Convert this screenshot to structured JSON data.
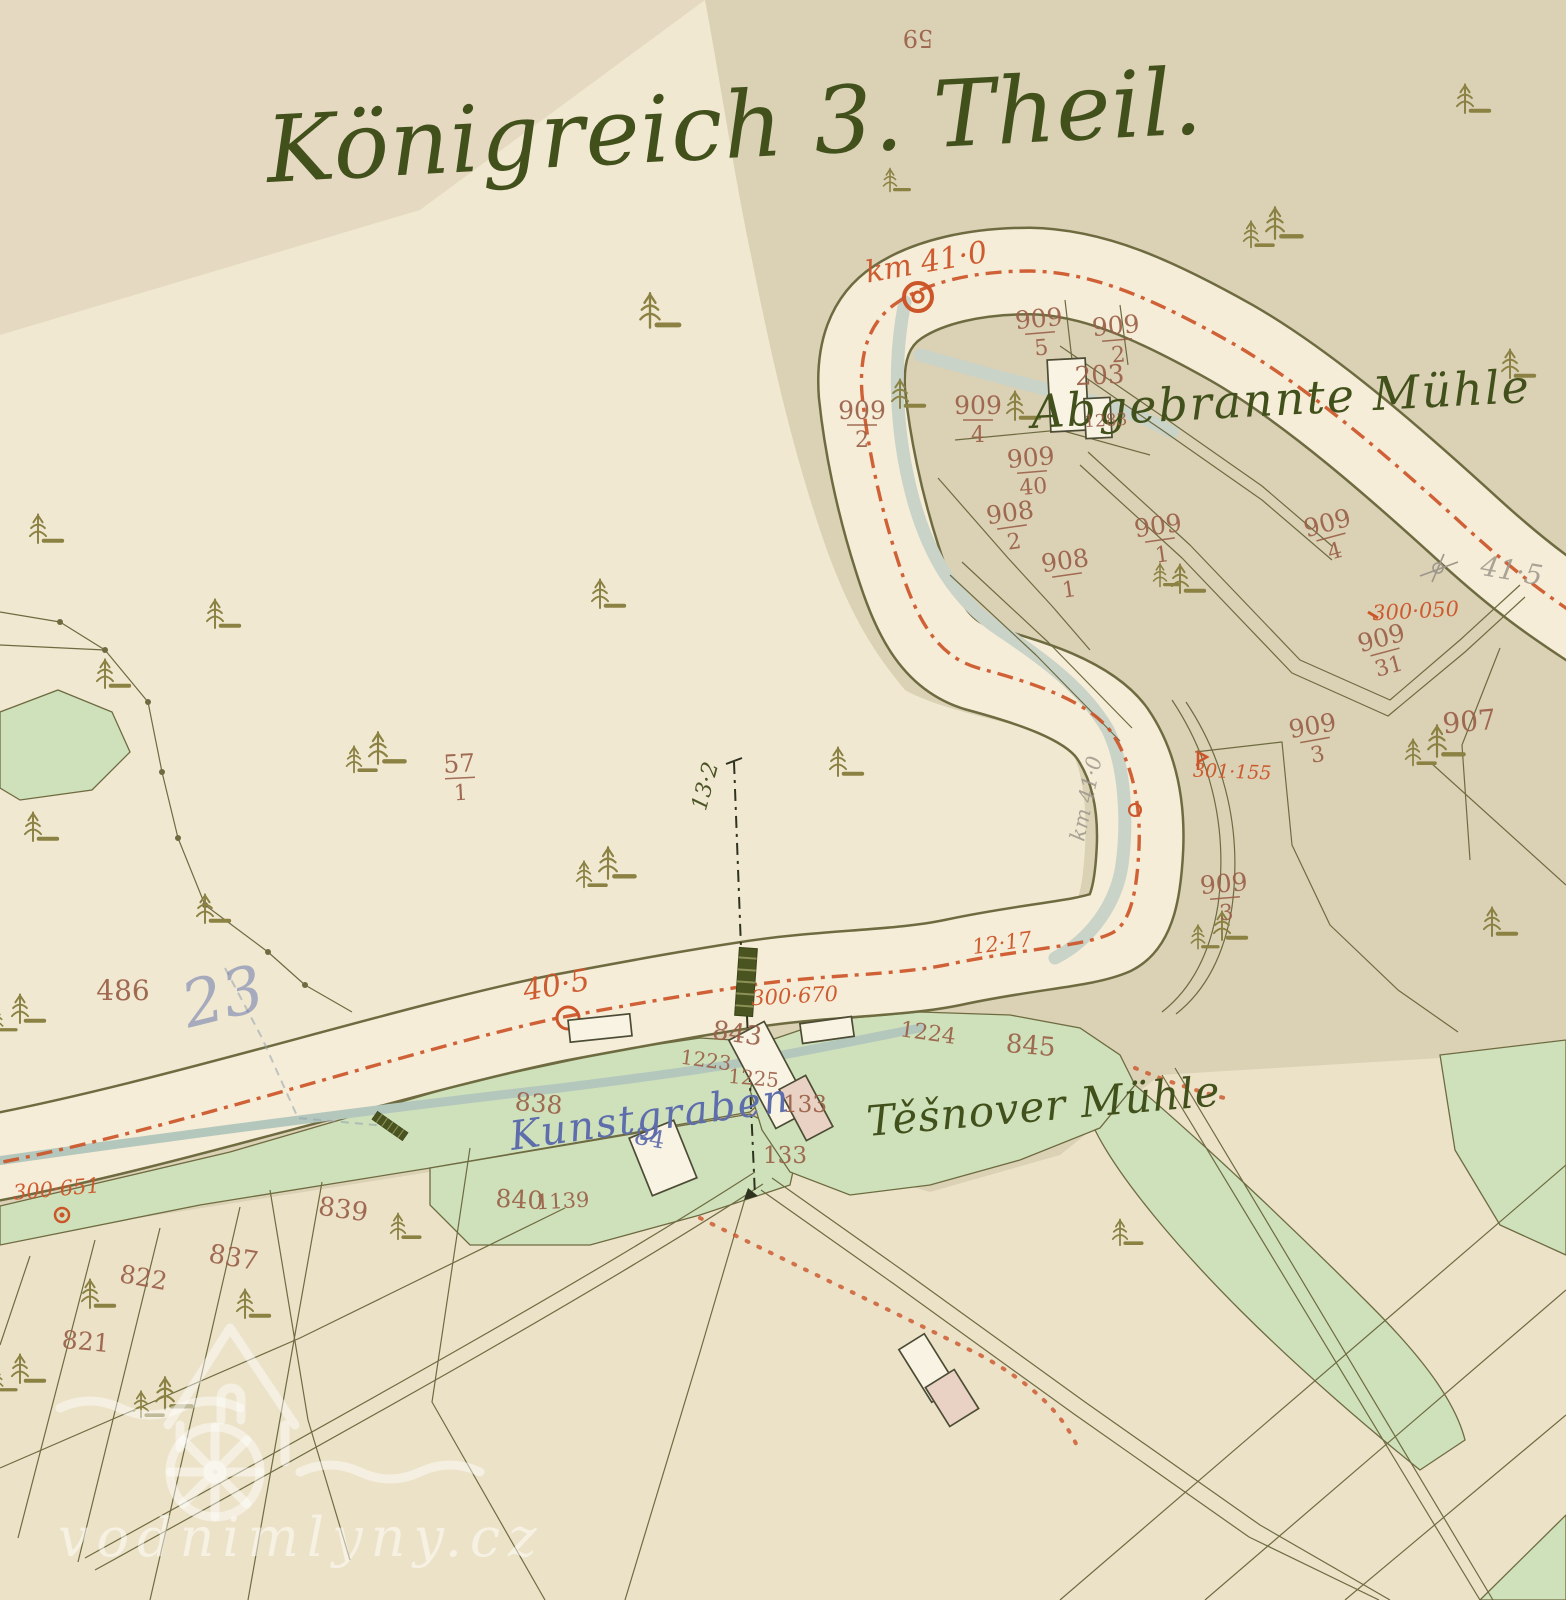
{
  "colors": {
    "paper-light": "#f1e8d1",
    "paper-fields": "#ece2c8",
    "paper-tan": "#dbd1b5",
    "band-cream": "#f5edd7",
    "line-olive": "#6e6b41",
    "tree-olive": "#8a8143",
    "meadow": "#cfe1bb",
    "stream": "#c9d3c8",
    "stream2": "#b4c7bc",
    "road-red": "#cc5529",
    "sepia": "#9a6048",
    "ink-green": "#42511c",
    "ink-blue": "#5e6dab",
    "pencil": "#9d978b",
    "bldg": "#f8f3e3",
    "bldg-pink": "#e9d2c3",
    "bridge-dark": "#4a5420"
  },
  "title": {
    "text": "Königreich 3. Theil."
  },
  "place_labels": {
    "abgebrannte": "Abgebrannte Mühle",
    "tesnover": "Těšnover Mühle",
    "kunstgraben": "Kunstgraben"
  },
  "annotations": {
    "blue_note": "23"
  },
  "watermark": {
    "text": "vodnimlyny.cz"
  },
  "icons": {
    "tree": "conifer-tree",
    "km_marker": "kilometer-circle-marker",
    "bridge": "bridge-hatch-marker"
  },
  "parcel_fractions": [
    {
      "n": "909",
      "d": "5",
      "x": 1040,
      "y": 333,
      "r": -5
    },
    {
      "n": "909",
      "d": "2",
      "x": 1117,
      "y": 340,
      "r": -5
    },
    {
      "n": "909",
      "d": "2",
      "x": 862,
      "y": 425,
      "r": 0
    },
    {
      "n": "909",
      "d": "4",
      "x": 978,
      "y": 420,
      "r": 0
    },
    {
      "n": "909",
      "d": "40",
      "x": 1032,
      "y": 472,
      "r": -5
    },
    {
      "n": "908",
      "d": "2",
      "x": 1012,
      "y": 527,
      "r": -8
    },
    {
      "n": "908",
      "d": "1",
      "x": 1067,
      "y": 575,
      "r": -8
    },
    {
      "n": "909",
      "d": "1",
      "x": 1160,
      "y": 540,
      "r": -8
    },
    {
      "n": "909",
      "d": "4",
      "x": 1331,
      "y": 537,
      "r": -15
    },
    {
      "n": "909",
      "d": "31",
      "x": 1385,
      "y": 652,
      "r": -15
    },
    {
      "n": "909",
      "d": "3",
      "x": 1315,
      "y": 740,
      "r": -10
    },
    {
      "n": "909",
      "d": "3",
      "x": 1225,
      "y": 898,
      "r": -5
    },
    {
      "n": "57",
      "d": "1",
      "x": 460,
      "y": 778,
      "r": -3
    }
  ],
  "parcel_numbers": [
    {
      "t": "59",
      "x": 918,
      "y": 30,
      "r": 180,
      "s": 24
    },
    {
      "t": "203",
      "x": 1100,
      "y": 384,
      "r": -3,
      "s": 26
    },
    {
      "t": "1283",
      "x": 1106,
      "y": 426,
      "r": -3,
      "s": 17
    },
    {
      "t": "907",
      "x": 1470,
      "y": 731,
      "r": -5,
      "s": 28
    },
    {
      "t": "486",
      "x": 123,
      "y": 1000,
      "r": 0,
      "s": 28
    },
    {
      "t": "843",
      "x": 736,
      "y": 1042,
      "r": 8,
      "s": 26
    },
    {
      "t": "1223",
      "x": 705,
      "y": 1067,
      "r": 8,
      "s": 20
    },
    {
      "t": "1225",
      "x": 753,
      "y": 1085,
      "r": 5,
      "s": 20
    },
    {
      "t": "133",
      "x": 805,
      "y": 1112,
      "r": 0,
      "s": 23
    },
    {
      "t": "133",
      "x": 785,
      "y": 1163,
      "r": 0,
      "s": 23
    },
    {
      "t": "1224",
      "x": 927,
      "y": 1040,
      "r": 8,
      "s": 22
    },
    {
      "t": "845",
      "x": 1030,
      "y": 1054,
      "r": 5,
      "s": 26
    },
    {
      "t": "838",
      "x": 538,
      "y": 1112,
      "r": 5,
      "s": 25
    },
    {
      "t": "84",
      "x": 648,
      "y": 1146,
      "r": 10,
      "s": 24,
      "c": "blue"
    },
    {
      "t": "840",
      "x": 519,
      "y": 1208,
      "r": 3,
      "s": 25
    },
    {
      "t": "1139",
      "x": 563,
      "y": 1208,
      "r": -3,
      "s": 21
    },
    {
      "t": "839",
      "x": 342,
      "y": 1218,
      "r": 8,
      "s": 26
    },
    {
      "t": "837",
      "x": 232,
      "y": 1266,
      "r": 10,
      "s": 26
    },
    {
      "t": "822",
      "x": 142,
      "y": 1286,
      "r": 10,
      "s": 25
    },
    {
      "t": "821",
      "x": 85,
      "y": 1350,
      "r": 5,
      "s": 25
    }
  ],
  "red_labels": [
    {
      "t": "km 41·0",
      "x": 928,
      "y": 272,
      "r": -10,
      "s": 30
    },
    {
      "t": "40·5",
      "x": 558,
      "y": 995,
      "r": -10,
      "s": 30
    },
    {
      "t": "300·670",
      "x": 795,
      "y": 1003,
      "r": -3,
      "s": 21
    },
    {
      "t": "12·17",
      "x": 1003,
      "y": 950,
      "r": -8,
      "s": 21
    },
    {
      "t": "301·155",
      "x": 1232,
      "y": 778,
      "r": 2,
      "s": 19
    },
    {
      "t": "300·050",
      "x": 1416,
      "y": 618,
      "r": -3,
      "s": 21
    },
    {
      "t": "300·651",
      "x": 57,
      "y": 1196,
      "r": -5,
      "s": 21
    }
  ],
  "pencil_labels": [
    {
      "t": "41·5",
      "x": 1510,
      "y": 580,
      "r": 10,
      "s": 28
    },
    {
      "t": "km 41·0",
      "x": 1093,
      "y": 800,
      "r": -78,
      "s": 21
    }
  ],
  "measure_labels": [
    {
      "t": "13·2",
      "x": 712,
      "y": 788,
      "r": -75,
      "s": 22
    }
  ]
}
